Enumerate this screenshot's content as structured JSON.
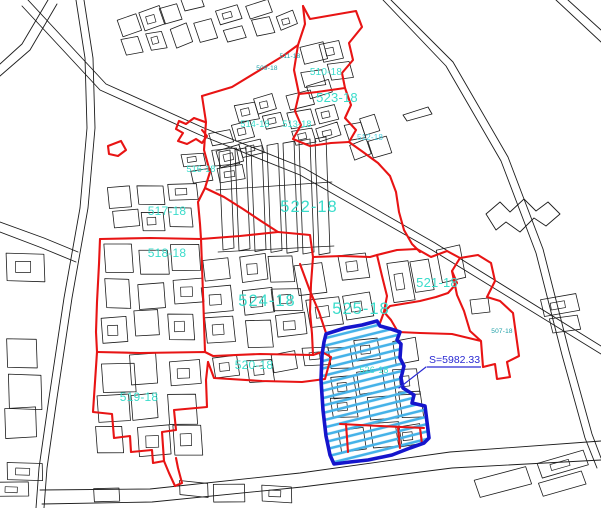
{
  "map": {
    "type": "cadastral-plan",
    "parcel_labels": [
      {
        "text": "509-18",
        "x": 267,
        "y": 70,
        "cls": "small"
      },
      {
        "text": "511-18",
        "x": 290,
        "y": 58,
        "cls": "small"
      },
      {
        "text": "510-18",
        "x": 326,
        "y": 75,
        "cls": "med"
      },
      {
        "text": "523-18",
        "x": 337,
        "y": 102,
        "cls": "big2"
      },
      {
        "text": "514-18",
        "x": 255,
        "y": 127,
        "cls": "med2"
      },
      {
        "text": "513-18",
        "x": 297,
        "y": 127,
        "cls": "med2"
      },
      {
        "text": "512-18",
        "x": 370,
        "y": 140,
        "cls": "small2"
      },
      {
        "text": "516-18",
        "x": 201,
        "y": 172,
        "cls": "med2"
      },
      {
        "text": "522-18",
        "x": 309,
        "y": 212,
        "cls": "huge"
      },
      {
        "text": "517-18",
        "x": 167,
        "y": 215,
        "cls": "big"
      },
      {
        "text": "518-18",
        "x": 167,
        "y": 257,
        "cls": "big"
      },
      {
        "text": "524-18",
        "x": 267,
        "y": 306,
        "cls": "huge"
      },
      {
        "text": "525-18",
        "x": 361,
        "y": 314,
        "cls": "huge"
      },
      {
        "text": "521-18",
        "x": 437,
        "y": 287,
        "cls": "big2"
      },
      {
        "text": "520-18",
        "x": 254,
        "y": 369,
        "cls": "big"
      },
      {
        "text": "519-18",
        "x": 139,
        "y": 401,
        "cls": "big"
      },
      {
        "text": "526-18",
        "x": 374,
        "y": 373,
        "cls": "med2"
      },
      {
        "text": "507-18",
        "x": 502,
        "y": 333,
        "cls": "small"
      }
    ],
    "area_annotation": {
      "text": "S=5982.33",
      "x": 429,
      "y": 363,
      "underline": [
        427,
        367,
        481,
        367
      ],
      "leader": [
        [
          399,
          388
        ],
        [
          426,
          367
        ]
      ]
    },
    "colors": {
      "boundary_red": "#e81414",
      "selection_blue": "#1515cc",
      "hatch_cyan": "#45b2e8",
      "label_cyan": "#3adccb",
      "label_teal": "#1d9fa6",
      "label_light": "#49d0e0",
      "area_text_blue": "#2a2ad2",
      "line_black": "#1c1c1c"
    }
  }
}
